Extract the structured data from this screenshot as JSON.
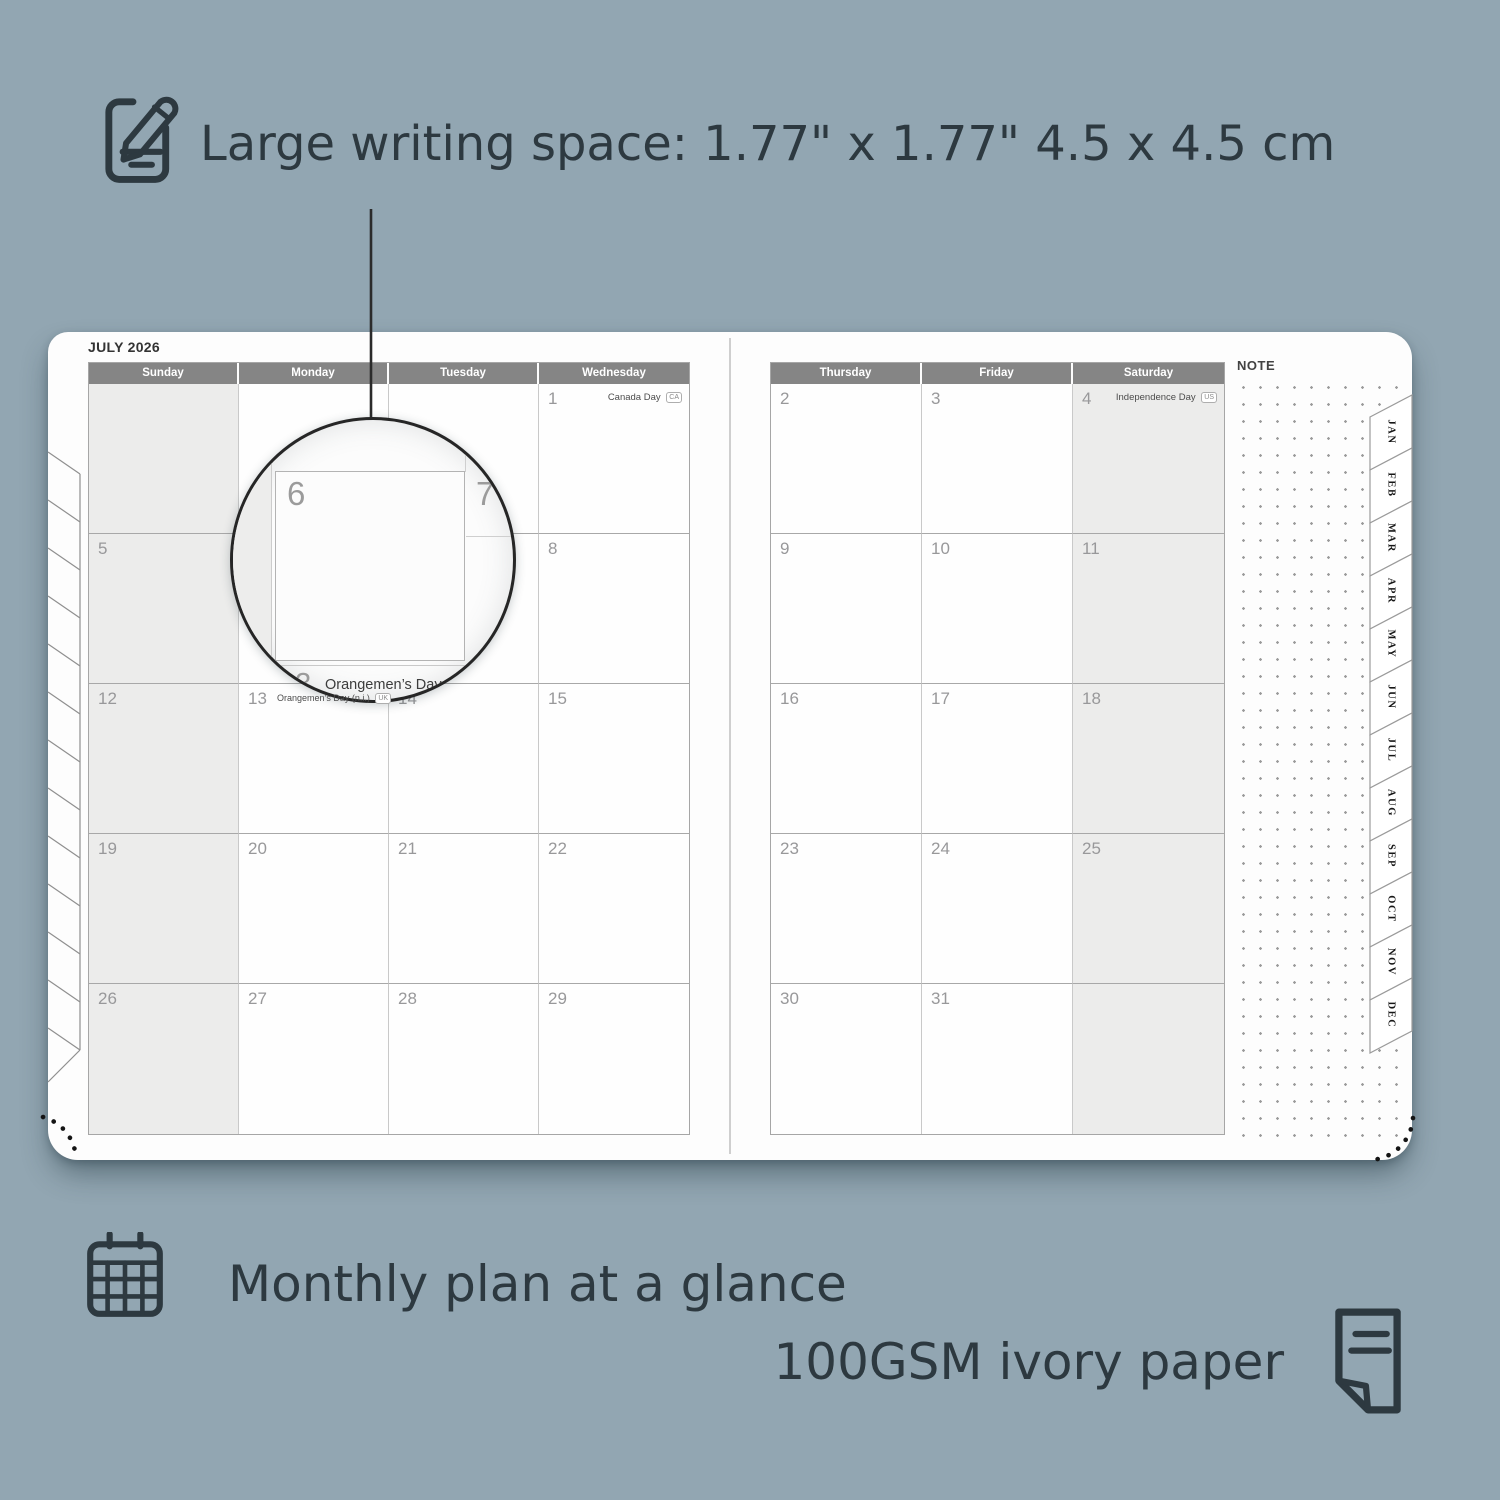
{
  "colors": {
    "background": "#92a6b2",
    "accent_dark": "#2d3940",
    "header_gray": "#858585",
    "shaded_cell": "#ececeb",
    "page_white": "#fdfdfd",
    "date_number": "#98989a"
  },
  "icons": {
    "top": "pencil-note-icon",
    "monthly": "calendar-grid-icon",
    "paper": "paper-sheet-icon"
  },
  "callouts": {
    "writing_space": "Large writing space: 1.77\" x 1.77\" 4.5 x 4.5 cm",
    "monthly_plan": "Monthly plan at a glance",
    "paper": "100GSM ivory paper"
  },
  "planner": {
    "title": "JULY 2026",
    "note_label": "NOTE",
    "left_day_headers": [
      "Sunday",
      "Monday",
      "Tuesday",
      "Wednesday"
    ],
    "right_day_headers": [
      "Thursday",
      "Friday",
      "Saturday"
    ],
    "left_rows": [
      [
        {
          "day": ""
        },
        {
          "day": ""
        },
        {
          "day": ""
        },
        {
          "day": "1",
          "holiday": "Canada Day",
          "badge": "CA"
        }
      ],
      [
        {
          "day": "5"
        },
        {
          "day": "6"
        },
        {
          "day": "7"
        },
        {
          "day": "8"
        }
      ],
      [
        {
          "day": "12"
        },
        {
          "day": "13",
          "holiday": "Orangemen’s Day (n.i.)",
          "badge": "UK",
          "holiday_align": "left"
        },
        {
          "day": "14"
        },
        {
          "day": "15"
        }
      ],
      [
        {
          "day": "19"
        },
        {
          "day": "20"
        },
        {
          "day": "21"
        },
        {
          "day": "22"
        }
      ],
      [
        {
          "day": "26"
        },
        {
          "day": "27"
        },
        {
          "day": "28"
        },
        {
          "day": "29"
        }
      ]
    ],
    "right_rows": [
      [
        {
          "day": "2"
        },
        {
          "day": "3"
        },
        {
          "day": "4",
          "holiday": "Independence Day",
          "badge": "US"
        }
      ],
      [
        {
          "day": "9"
        },
        {
          "day": "10"
        },
        {
          "day": "11"
        }
      ],
      [
        {
          "day": "16"
        },
        {
          "day": "17"
        },
        {
          "day": "18"
        }
      ],
      [
        {
          "day": "23"
        },
        {
          "day": "24"
        },
        {
          "day": "25"
        }
      ],
      [
        {
          "day": "30"
        },
        {
          "day": "31"
        },
        {
          "day": ""
        }
      ]
    ],
    "month_tabs": [
      "JAN",
      "FEB",
      "MAR",
      "APR",
      "MAY",
      "JUN",
      "JUL",
      "AUG",
      "SEP",
      "OCT",
      "NOV",
      "DEC"
    ],
    "magnifier": {
      "day_main": "6",
      "day_next": "7",
      "day_below": "13",
      "holiday": "Orangemen’s Day (n.i.)",
      "badge": "UK"
    }
  }
}
